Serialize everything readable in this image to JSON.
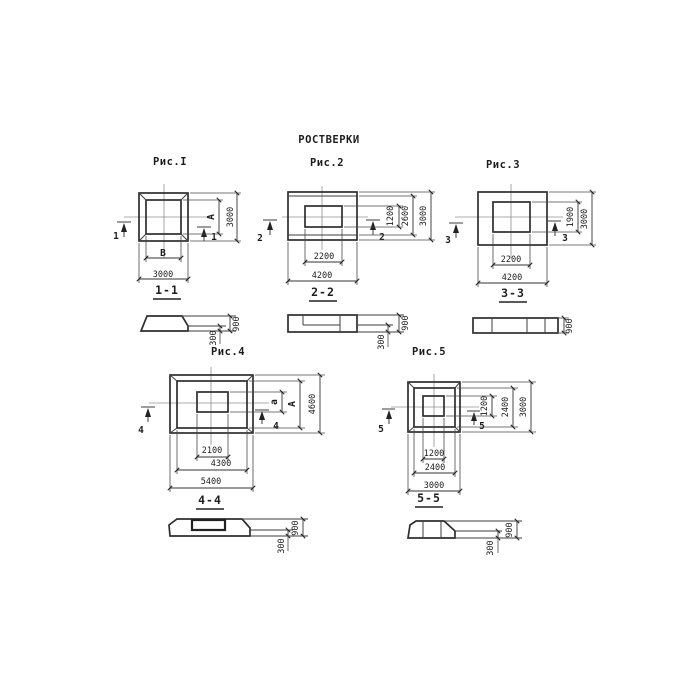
{
  "title": "РОСТВЕРКИ",
  "figures": {
    "fig1": {
      "caption": "Рис.I",
      "cut": "1",
      "plan": {
        "inner_width": "В",
        "outer_width": "3000",
        "inner_height": "А",
        "outer_height": "3000"
      },
      "section": {
        "label": "1-1",
        "total_height": "900",
        "ledge_height": "300"
      }
    },
    "fig2": {
      "caption": "Рис.2",
      "cut": "2",
      "plan": {
        "inner_width": "2200",
        "outer_width": "4200",
        "dim_h1": "1200",
        "dim_h2": "2600",
        "dim_h3": "3000"
      },
      "section": {
        "label": "2-2",
        "total_height": "900",
        "ledge_height": "300"
      }
    },
    "fig3": {
      "caption": "Рис.3",
      "cut": "3",
      "plan": {
        "inner_width": "2200",
        "outer_width": "4200",
        "inner_height": "1900",
        "outer_height": "3000"
      },
      "section": {
        "label": "3-3",
        "total_height": "900"
      }
    },
    "fig4": {
      "caption": "Рис.4",
      "cut": "4",
      "plan": {
        "dim_w1": "2100",
        "dim_w2": "4300",
        "dim_w3": "5400",
        "dim_h1": "а",
        "dim_h2": "А",
        "dim_h3": "4600"
      },
      "section": {
        "label": "4-4",
        "total_height": "900",
        "ledge_height": "300"
      }
    },
    "fig5": {
      "caption": "Рис.5",
      "cut": "5",
      "plan": {
        "dim_w1": "1200",
        "dim_w2": "2400",
        "dim_w3": "3000",
        "dim_h1": "1200",
        "dim_h2": "2400",
        "dim_h3": "3000"
      },
      "section": {
        "label": "5-5",
        "total_height": "900",
        "ledge_height": "300"
      }
    }
  }
}
